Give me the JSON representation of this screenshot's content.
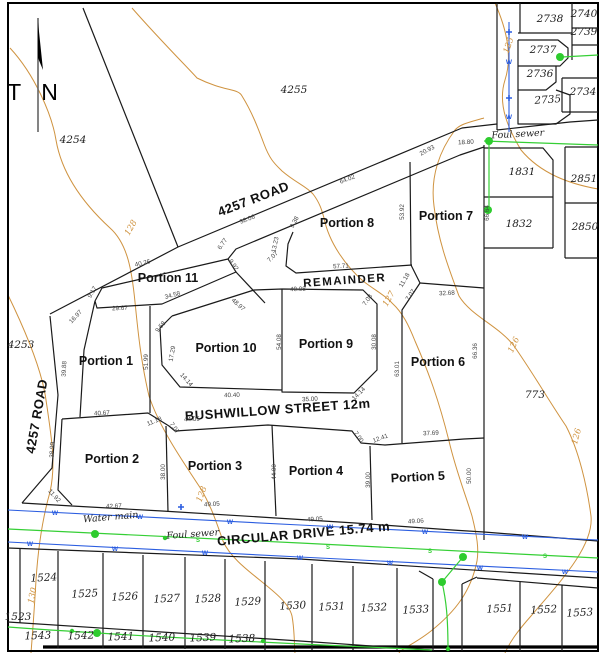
{
  "north": {
    "label": "T N"
  },
  "colors": {
    "contour": "#cf9340",
    "water": "#2b5de0",
    "sewer": "#35cf35",
    "manhole": "#2ecc2e",
    "line": "#1a1a1a"
  },
  "streets": [
    "4257 ROAD",
    "BUSHWILLOW STREET 12m",
    "CIRCULAR DRIVE 15.74 m"
  ],
  "utilities": {
    "water_label": "Water main",
    "sewer_label": "Foul sewer",
    "manholes_big": [
      [
        95,
        534
      ],
      [
        463,
        557
      ],
      [
        442,
        582
      ],
      [
        97,
        633
      ],
      [
        560,
        57
      ],
      [
        489,
        141
      ],
      [
        488,
        210
      ]
    ],
    "manholes_small": [
      [
        72,
        631
      ],
      [
        263,
        641
      ],
      [
        165,
        538
      ],
      [
        448,
        649
      ]
    ],
    "hydrants": [
      [
        509,
        32
      ],
      [
        509,
        98
      ],
      [
        181,
        507
      ]
    ]
  },
  "layers": [
    {
      "name": "road-label",
      "cls": "lbl-road",
      "items": [
        {
          "t": "4257 ROAD",
          "x": 255,
          "y": 203,
          "r": -21
        },
        {
          "t": "4257 ROAD",
          "x": 41,
          "y": 417,
          "r": -80
        },
        {
          "t": "BUSHWILLOW STREET 12m",
          "x": 278,
          "y": 414,
          "r": -4
        },
        {
          "t": "CIRCULAR DRIVE 15.74 m",
          "x": 304,
          "y": 538,
          "r": -5
        }
      ]
    },
    {
      "name": "portion-label",
      "cls": "lbl-portion",
      "items": [
        {
          "t": "Portion 1",
          "x": 106,
          "y": 365,
          "r": 0
        },
        {
          "t": "Portion 2",
          "x": 112,
          "y": 463,
          "r": 0
        },
        {
          "t": "Portion 3",
          "x": 215,
          "y": 470,
          "r": 0
        },
        {
          "t": "Portion 4",
          "x": 316,
          "y": 475,
          "r": 0
        },
        {
          "t": "Portion 5",
          "x": 418,
          "y": 481,
          "r": -3
        },
        {
          "t": "Portion 6",
          "x": 438,
          "y": 366,
          "r": 0
        },
        {
          "t": "Portion 7",
          "x": 446,
          "y": 220,
          "r": 0
        },
        {
          "t": "Portion 8",
          "x": 347,
          "y": 227,
          "r": 0
        },
        {
          "t": "Portion 9",
          "x": 326,
          "y": 348,
          "r": 0
        },
        {
          "t": "Portion 10",
          "x": 226,
          "y": 352,
          "r": 0
        },
        {
          "t": "Portion 11",
          "x": 168,
          "y": 282,
          "r": 0
        }
      ]
    },
    {
      "name": "remainder-label",
      "cls": "lbl-remainder",
      "items": [
        {
          "t": "REMAINDER",
          "x": 345,
          "y": 284,
          "r": -4
        }
      ]
    },
    {
      "name": "lot-label",
      "cls": "lbl-lot",
      "items": [
        {
          "t": "4254",
          "x": 73,
          "y": 143,
          "r": 0
        },
        {
          "t": "4255",
          "x": 294,
          "y": 93,
          "r": 0
        },
        {
          "t": "4253",
          "x": 21,
          "y": 348,
          "r": 0
        },
        {
          "t": "773",
          "x": 535,
          "y": 398,
          "r": 0
        },
        {
          "t": "2738",
          "x": 550,
          "y": 22,
          "r": 0
        },
        {
          "t": "2740",
          "x": 584,
          "y": 17,
          "r": 0
        },
        {
          "t": "2739",
          "x": 584,
          "y": 35,
          "r": 0
        },
        {
          "t": "2737",
          "x": 543,
          "y": 53,
          "r": 0
        },
        {
          "t": "2736",
          "x": 540,
          "y": 77,
          "r": 0
        },
        {
          "t": "2735",
          "x": 548,
          "y": 103,
          "r": -4
        },
        {
          "t": "2734",
          "x": 583,
          "y": 95,
          "r": 0
        },
        {
          "t": "1831",
          "x": 522,
          "y": 175,
          "r": 0
        },
        {
          "t": "2851",
          "x": 584,
          "y": 182,
          "r": 0
        },
        {
          "t": "1832",
          "x": 519,
          "y": 227,
          "r": 0
        },
        {
          "t": "2850",
          "x": 585,
          "y": 230,
          "r": 0
        },
        {
          "t": "1523",
          "x": 18,
          "y": 620,
          "r": 0
        },
        {
          "t": "1524",
          "x": 44,
          "y": 581,
          "r": -3
        },
        {
          "t": "1525",
          "x": 85,
          "y": 597,
          "r": -3
        },
        {
          "t": "1526",
          "x": 125,
          "y": 600,
          "r": -3
        },
        {
          "t": "1527",
          "x": 167,
          "y": 602,
          "r": -3
        },
        {
          "t": "1528",
          "x": 208,
          "y": 602,
          "r": -3
        },
        {
          "t": "1529",
          "x": 248,
          "y": 605,
          "r": -3
        },
        {
          "t": "1530",
          "x": 293,
          "y": 609,
          "r": -3
        },
        {
          "t": "1531",
          "x": 332,
          "y": 610,
          "r": -3
        },
        {
          "t": "1532",
          "x": 374,
          "y": 611,
          "r": -3
        },
        {
          "t": "1533",
          "x": 416,
          "y": 613,
          "r": -3
        },
        {
          "t": "1551",
          "x": 500,
          "y": 612,
          "r": -3
        },
        {
          "t": "1552",
          "x": 544,
          "y": 613,
          "r": -3
        },
        {
          "t": "1553",
          "x": 580,
          "y": 616,
          "r": -3
        },
        {
          "t": "1543",
          "x": 38,
          "y": 639,
          "r": -2
        },
        {
          "t": "1542",
          "x": 81,
          "y": 639,
          "r": -2
        },
        {
          "t": "1541",
          "x": 121,
          "y": 640,
          "r": -2
        },
        {
          "t": "1540",
          "x": 162,
          "y": 641,
          "r": -2
        },
        {
          "t": "1539",
          "x": 203,
          "y": 641,
          "r": -2
        },
        {
          "t": "1538",
          "x": 242,
          "y": 642,
          "r": -2
        }
      ]
    },
    {
      "name": "contour-label",
      "cls": "lbl-contour",
      "items": [
        {
          "t": "125",
          "x": 511,
          "y": 46,
          "r": -72
        },
        {
          "t": "127",
          "x": 391,
          "y": 300,
          "r": -60
        },
        {
          "t": "126",
          "x": 516,
          "y": 346,
          "r": -65
        },
        {
          "t": "126",
          "x": 579,
          "y": 437,
          "r": -75
        },
        {
          "t": "128",
          "x": 133,
          "y": 229,
          "r": -60
        },
        {
          "t": "128",
          "x": 204,
          "y": 495,
          "r": -70
        },
        {
          "t": "130",
          "x": 35,
          "y": 596,
          "r": -78
        }
      ]
    },
    {
      "name": "utility-label",
      "cls": "lbl-util",
      "items": [
        {
          "t": "Water main",
          "x": 111,
          "y": 520,
          "r": -5
        },
        {
          "t": "Foul sewer",
          "x": 193,
          "y": 537,
          "r": -4
        },
        {
          "t": "Foul sewer",
          "x": 518,
          "y": 137,
          "r": -3
        }
      ]
    },
    {
      "name": "dimension-label",
      "cls": "lbl-dim",
      "items": [
        {
          "t": "18.80",
          "x": 466,
          "y": 144,
          "r": -3
        },
        {
          "t": "20.93",
          "x": 428,
          "y": 152,
          "r": -28
        },
        {
          "t": "64.02",
          "x": 348,
          "y": 181,
          "r": -21
        },
        {
          "t": "38.06",
          "x": 248,
          "y": 221,
          "r": -21
        },
        {
          "t": "9.38",
          "x": 296,
          "y": 223,
          "r": -62
        },
        {
          "t": "13.23",
          "x": 277,
          "y": 245,
          "r": -78
        },
        {
          "t": "7.07",
          "x": 274,
          "y": 258,
          "r": -45
        },
        {
          "t": "53.92",
          "x": 404,
          "y": 212,
          "r": -90
        },
        {
          "t": "66.64",
          "x": 489,
          "y": 213,
          "r": -90
        },
        {
          "t": "57.71",
          "x": 341,
          "y": 268,
          "r": -3
        },
        {
          "t": "11.18",
          "x": 406,
          "y": 281,
          "r": -60
        },
        {
          "t": "7.07",
          "x": 412,
          "y": 296,
          "r": -55
        },
        {
          "t": "32.68",
          "x": 447,
          "y": 295,
          "r": -3
        },
        {
          "t": "40.08",
          "x": 298,
          "y": 291,
          "r": -2
        },
        {
          "t": "7.08",
          "x": 369,
          "y": 301,
          "r": -55
        },
        {
          "t": "30.08",
          "x": 376,
          "y": 342,
          "r": -90
        },
        {
          "t": "54.08",
          "x": 281,
          "y": 342,
          "r": -90
        },
        {
          "t": "63.01",
          "x": 399,
          "y": 369,
          "r": -90
        },
        {
          "t": "66.36",
          "x": 477,
          "y": 351,
          "r": -90
        },
        {
          "t": "40.26",
          "x": 143,
          "y": 265,
          "r": -13
        },
        {
          "t": "6.77",
          "x": 224,
          "y": 245,
          "r": -55
        },
        {
          "t": "9.92",
          "x": 232,
          "y": 266,
          "r": 55
        },
        {
          "t": "48.97",
          "x": 237,
          "y": 306,
          "r": 42
        },
        {
          "t": "34.58",
          "x": 173,
          "y": 297,
          "r": -15
        },
        {
          "t": "29.67",
          "x": 120,
          "y": 310,
          "r": -3
        },
        {
          "t": "9.17",
          "x": 94,
          "y": 293,
          "r": -60
        },
        {
          "t": "16.97",
          "x": 77,
          "y": 318,
          "r": -47
        },
        {
          "t": "39.88",
          "x": 66,
          "y": 369,
          "r": -87
        },
        {
          "t": "51.99",
          "x": 148,
          "y": 362,
          "r": -90
        },
        {
          "t": "9.58",
          "x": 162,
          "y": 328,
          "r": -50
        },
        {
          "t": "17.29",
          "x": 174,
          "y": 354,
          "r": -80
        },
        {
          "t": "14.14",
          "x": 185,
          "y": 381,
          "r": 48
        },
        {
          "t": "40.40",
          "x": 232,
          "y": 397,
          "r": -2
        },
        {
          "t": "35.00",
          "x": 310,
          "y": 401,
          "r": -3
        },
        {
          "t": "14.14",
          "x": 360,
          "y": 395,
          "r": -45
        },
        {
          "t": "38.99",
          "x": 54,
          "y": 450,
          "r": -87
        },
        {
          "t": "40.67",
          "x": 102,
          "y": 415,
          "r": -3
        },
        {
          "t": "11.18",
          "x": 155,
          "y": 423,
          "r": -22
        },
        {
          "t": "7.07",
          "x": 173,
          "y": 429,
          "r": 55
        },
        {
          "t": "44.05",
          "x": 192,
          "y": 421,
          "r": -3
        },
        {
          "t": "38.00",
          "x": 165,
          "y": 472,
          "r": -90
        },
        {
          "t": "44.00",
          "x": 276,
          "y": 472,
          "r": -90
        },
        {
          "t": "7.00",
          "x": 357,
          "y": 438,
          "r": 55
        },
        {
          "t": "12.41",
          "x": 381,
          "y": 440,
          "r": -20
        },
        {
          "t": "37.69",
          "x": 431,
          "y": 435,
          "r": -3
        },
        {
          "t": "39.00",
          "x": 370,
          "y": 480,
          "r": -90
        },
        {
          "t": "50.00",
          "x": 471,
          "y": 476,
          "r": -90
        },
        {
          "t": "11.92",
          "x": 53,
          "y": 497,
          "r": 48
        },
        {
          "t": "42.67",
          "x": 114,
          "y": 508,
          "r": -3
        },
        {
          "t": "49.05",
          "x": 212,
          "y": 506,
          "r": -4
        },
        {
          "t": "49.05",
          "x": 315,
          "y": 521,
          "r": -4
        },
        {
          "t": "49.06",
          "x": 416,
          "y": 523,
          "r": -4
        }
      ]
    },
    {
      "name": "water-marker",
      "cls": "lbl-w",
      "items": [
        {
          "t": "W",
          "x": 55,
          "y": 515,
          "r": 0
        },
        {
          "t": "W",
          "x": 140,
          "y": 519,
          "r": 0
        },
        {
          "t": "W",
          "x": 230,
          "y": 524,
          "r": 0
        },
        {
          "t": "W",
          "x": 330,
          "y": 529,
          "r": 0
        },
        {
          "t": "W",
          "x": 425,
          "y": 534,
          "r": 0
        },
        {
          "t": "W",
          "x": 525,
          "y": 539,
          "r": 0
        },
        {
          "t": "W",
          "x": 30,
          "y": 546,
          "r": 0
        },
        {
          "t": "W",
          "x": 115,
          "y": 551,
          "r": 0
        },
        {
          "t": "W",
          "x": 205,
          "y": 555,
          "r": 0
        },
        {
          "t": "W",
          "x": 300,
          "y": 560,
          "r": 0
        },
        {
          "t": "W",
          "x": 390,
          "y": 565,
          "r": 0
        },
        {
          "t": "W",
          "x": 480,
          "y": 570,
          "r": 0
        },
        {
          "t": "W",
          "x": 565,
          "y": 574,
          "r": 0
        },
        {
          "t": "W",
          "x": 509,
          "y": 119,
          "r": 0
        },
        {
          "t": "W",
          "x": 509,
          "y": 64,
          "r": 0
        }
      ]
    },
    {
      "name": "sewer-marker",
      "cls": "lbl-s",
      "items": [
        {
          "t": "S",
          "x": 198,
          "y": 542,
          "r": 0
        },
        {
          "t": "S",
          "x": 328,
          "y": 549,
          "r": 0
        },
        {
          "t": "S",
          "x": 430,
          "y": 553,
          "r": 0
        },
        {
          "t": "S",
          "x": 545,
          "y": 558,
          "r": 0
        }
      ]
    }
  ]
}
